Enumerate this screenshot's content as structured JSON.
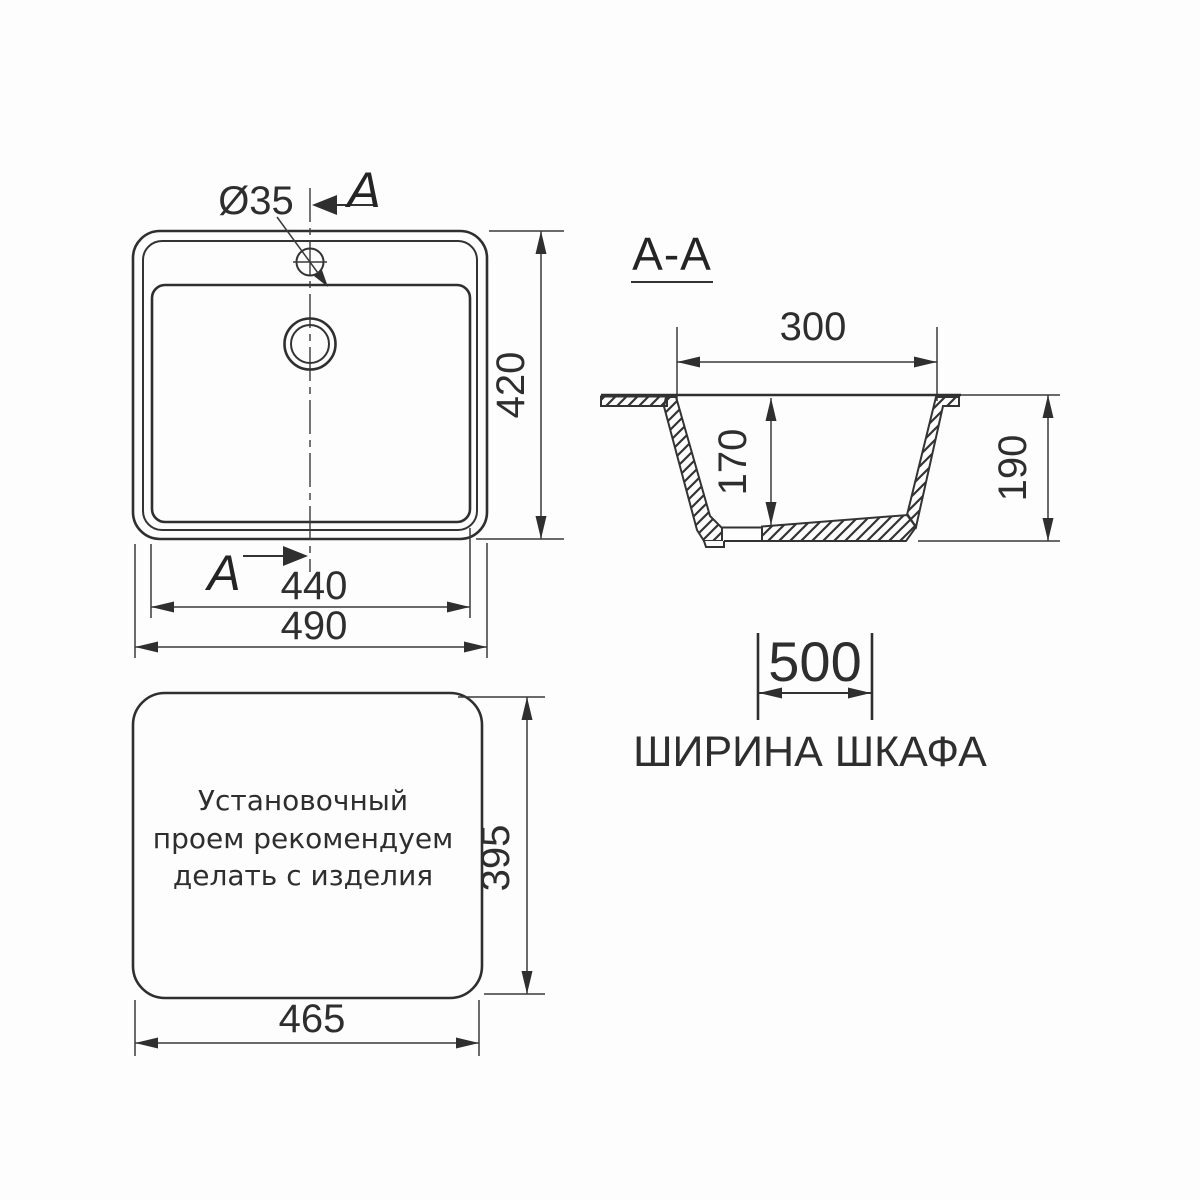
{
  "drawing": {
    "type": "sink technical drawing, three views",
    "plan_view": {
      "hole_label": "Ø35",
      "section_arrow_top": "A",
      "section_arrow_bottom": "A",
      "dim_depth": "420",
      "dim_bowl_width": "440",
      "dim_overall_width": "490"
    },
    "section_view": {
      "title": "A-A",
      "dim_opening": "300",
      "dim_bowl_depth": "170",
      "dim_overall_depth": "190"
    },
    "cabinet": {
      "dim_width": "500",
      "caption": "ШИРИНА ШКАФА"
    },
    "cutout_view": {
      "note_line1": "Установочный",
      "note_line2": "проем рекомендуем",
      "note_line3": "делать с изделия",
      "dim_width": "465",
      "dim_height": "395"
    },
    "colors": {
      "line": "#333333",
      "background": "#fdfdfd"
    }
  }
}
